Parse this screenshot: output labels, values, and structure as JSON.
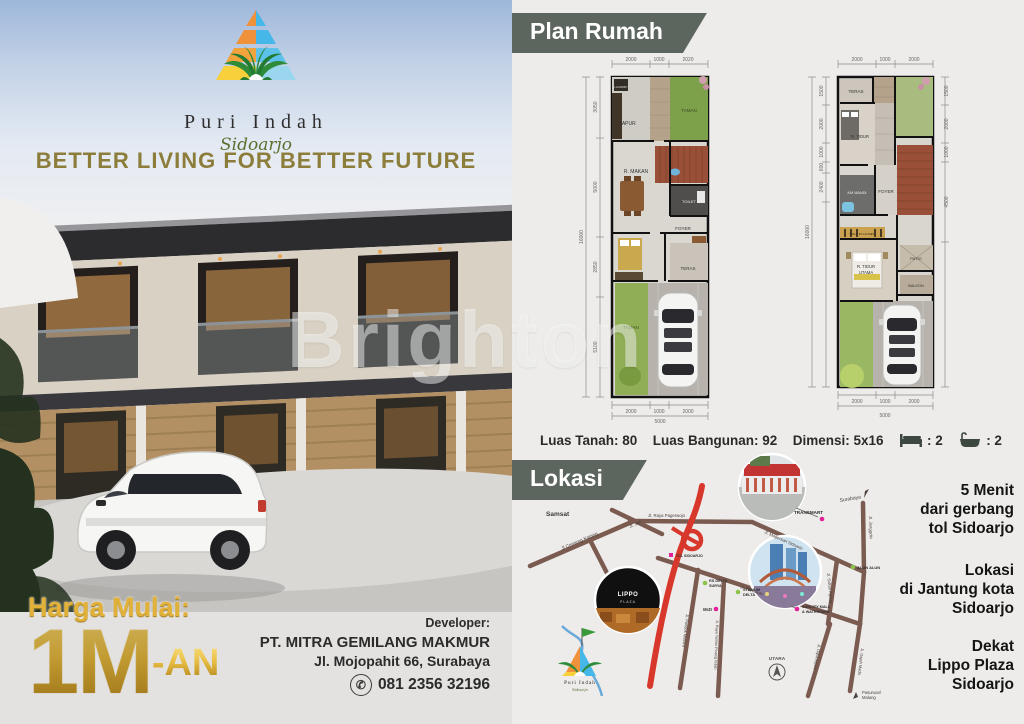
{
  "branding": {
    "title": "Puri Indah",
    "subtitle": "Sidoarjo",
    "tagline": "BETTER LIVING FOR BETTER FUTURE"
  },
  "watermark": "Brighton",
  "price": {
    "label": "Harga Mulai:",
    "value": "1M",
    "suffix": "-AN"
  },
  "developer": {
    "label": "Developer:",
    "name": "PT. MITRA GEMILANG MAKMUR",
    "address": "Jl. Mojopahit 66, Surabaya",
    "phone": "081 2356 32196"
  },
  "plan_section": {
    "header": "Plan Rumah",
    "specs": {
      "luas_tanah": "Luas Tanah: 80",
      "luas_bangunan": "Luas Bangunan: 92",
      "dimensi": "Dimensi: 5x16",
      "beds": ": 2",
      "baths": ": 2"
    },
    "plan1": {
      "rooms": {
        "laundry": "LAUNDRY",
        "dapur": "DAPUR",
        "taman_atas": "TAMAN",
        "r_makan": "R. MAKAN",
        "toilet": "TOILET",
        "foyer": "FOYER",
        "teras": "TERAS",
        "taman_bawah": "TAMAN"
      },
      "dims": {
        "top1": "2000",
        "top2": "1000",
        "top3": "2020",
        "left1": "3050",
        "left2": "5000",
        "left3": "2850",
        "left4": "5100",
        "left_total": "16000",
        "bottom1": "2000",
        "bottom2": "1000",
        "bottom3": "2000",
        "bottom_total": "5000"
      }
    },
    "plan2": {
      "rooms": {
        "teras": "TERAS",
        "r_tidur": "R. TIDUR",
        "km_mandi": "KM MANDI",
        "foyer": "FOYER",
        "walkin": "WALK IN CLOSET",
        "r_tidur_utama_1": "R. TIDUR",
        "r_tidur_utama_2": "UTAMA",
        "patio": "PATIO",
        "balkon": "BALKON"
      },
      "dims": {
        "top1": "2000",
        "top2": "1000",
        "top3": "2000",
        "left1": "1500",
        "left2": "2000",
        "left3": "1000",
        "left4": "600",
        "left5": "2400",
        "left_total": "16000",
        "right1": "1500",
        "right2": "2000",
        "right3": "1000",
        "right4": "4500",
        "bottom1": "2000",
        "bottom2": "1000",
        "bottom3": "2000",
        "bottom_total": "5000"
      }
    }
  },
  "lokasi_section": {
    "header": "Lokasi",
    "highlights": [
      {
        "l1": "5 Menit",
        "l2": "dari gerbang",
        "l3": "tol Sidoarjo"
      },
      {
        "l1": "Lokasi",
        "l2": "di Jantung kota",
        "l3": "Sidoarjo"
      },
      {
        "l1": "Dekat",
        "l2": "Lippo Plaza",
        "l3": "Sidoarjo"
      }
    ],
    "map": {
      "places": {
        "samsat": "Samsat",
        "transmart": "TRANSMART",
        "lippo_1": "LIPPO",
        "lippo_2": "PLAZA",
        "rs_delta_1": "RS DELTA",
        "rs_delta_2": "SURYA",
        "stadium_1": "STADIUM",
        "stadium_2": "DELTA",
        "mcd": "McD",
        "suncity_1": "SUNCITY MALL",
        "suncity_2": "& WATERPARK",
        "alun": "ALUN ALUN",
        "tol": "TOL SIDOARJO"
      },
      "roads": {
        "cemeng": "Jl Cemeng Kalang",
        "jati": "Jl. Jati",
        "pagerwojo": "Jl. Raya Pagerwojo",
        "magersari": "Jl. Magersari Sidoarjo",
        "jenggolo": "Jl. Jenggolo",
        "sultan": "Jl. Sultan Agung",
        "pahlawan": "Jl. Pahlawan",
        "pondok": "Jl. Pondok Mutiara",
        "pinang": "Jl. Raya Taman Pinang Indah",
        "diponegoro": "Jl. Diponegoro",
        "gajah": "Jl. Gajah Mada"
      },
      "directions": {
        "surabaya": "Surabaya",
        "pasuruan_1": "Pasuruan/",
        "pasuruan_2": "Malang",
        "utara": "UTARA"
      },
      "logo_title": "Puri Indah",
      "logo_subtitle": "Sidoarjo"
    }
  },
  "colors": {
    "banner": "#5c665e",
    "gold": "#d9a82c",
    "toll_red": "#d8372b",
    "road_brown": "#7b5a50",
    "magenta": "#e0219a",
    "green_dot": "#8bc34a"
  }
}
